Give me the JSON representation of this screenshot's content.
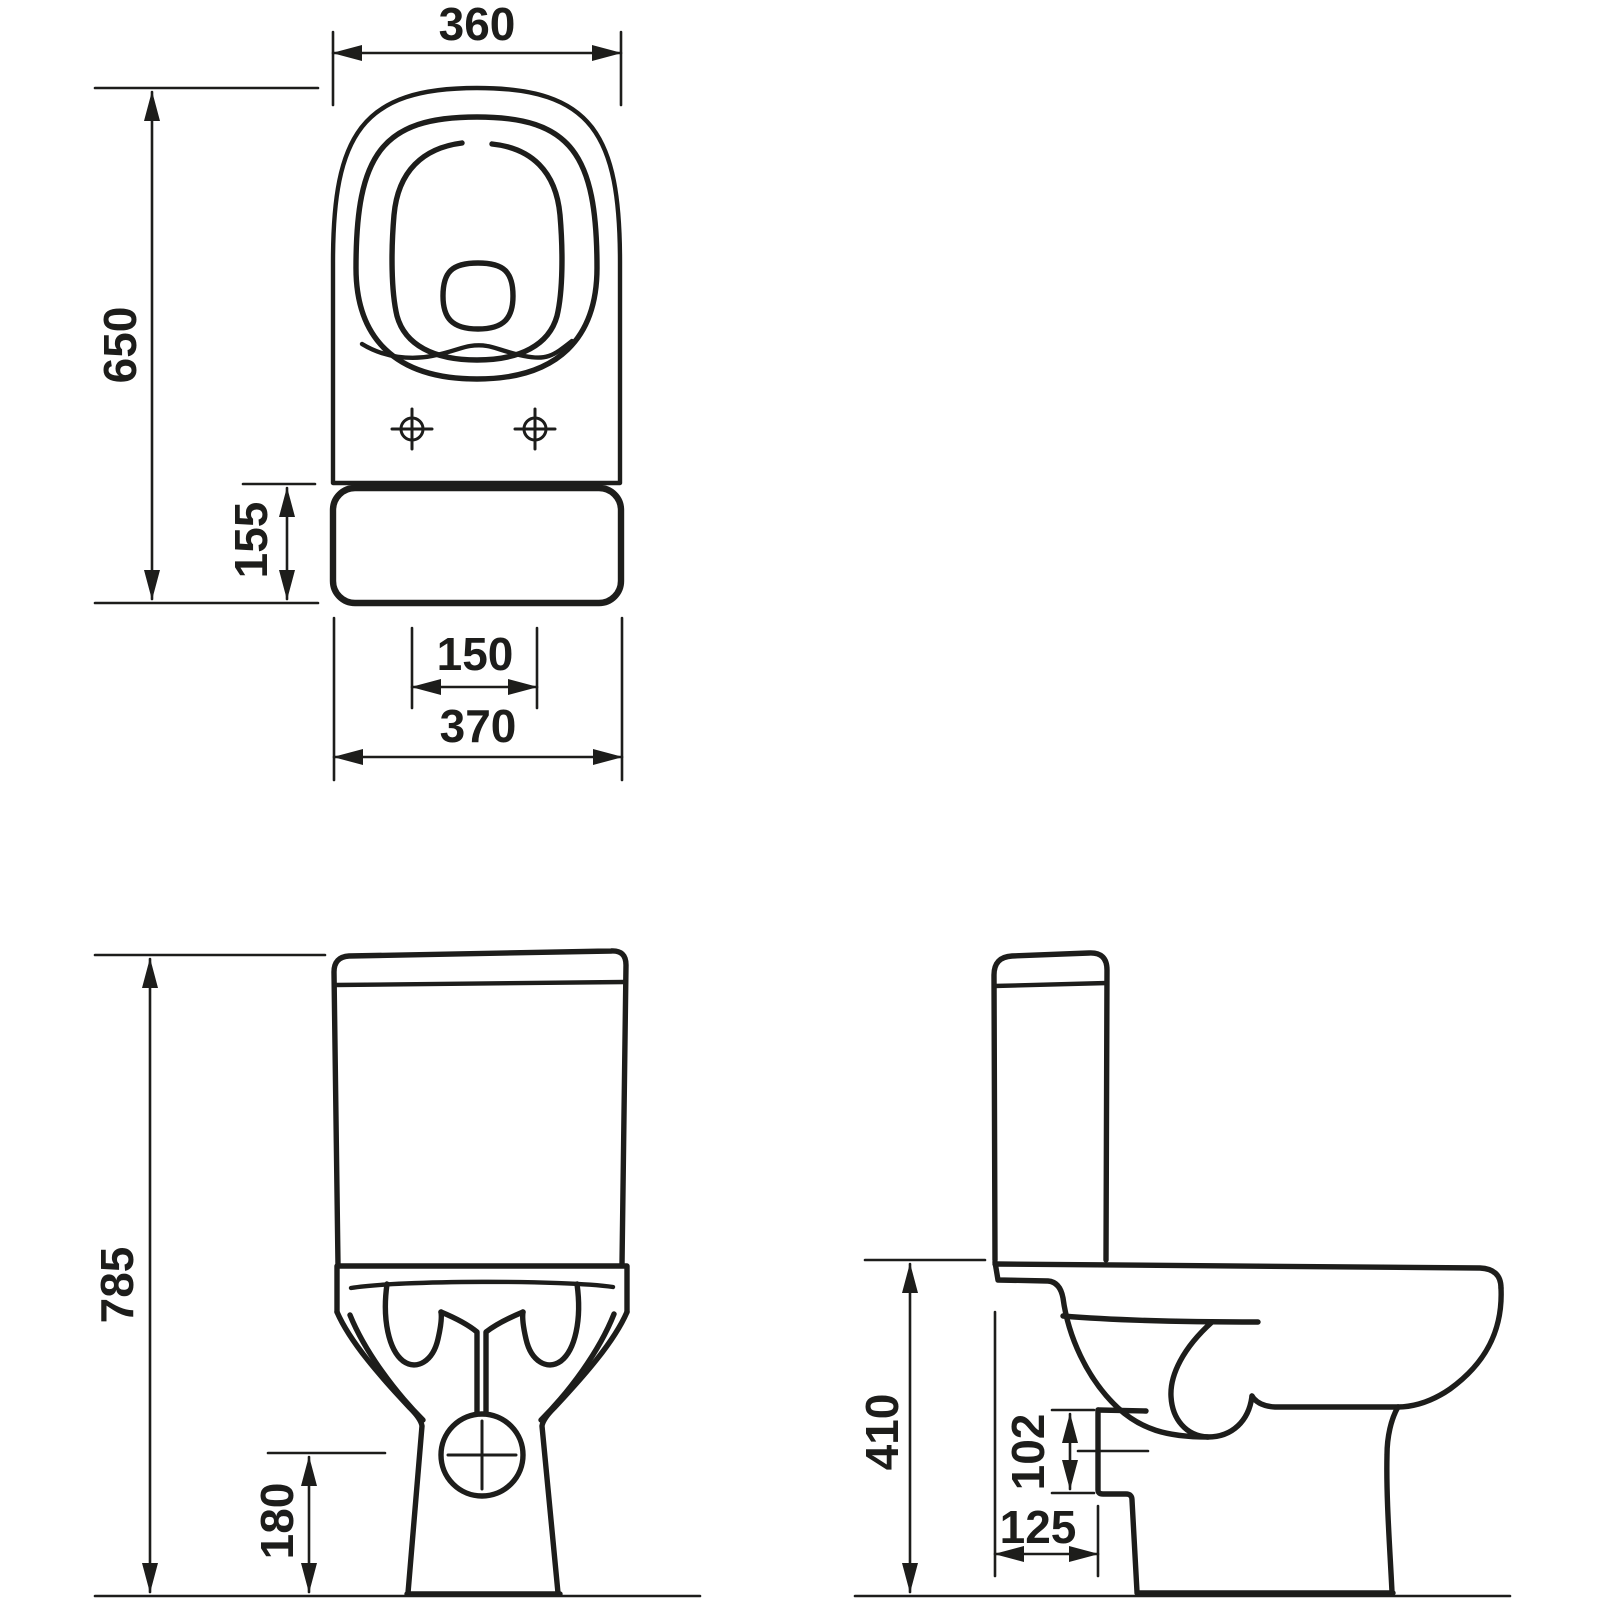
{
  "meta": {
    "doc_type": "technical dimension drawing",
    "subject": "close-coupled toilet (WC) with cistern",
    "views": [
      "top view",
      "front view",
      "side view"
    ]
  },
  "colors": {
    "line": "#1d1d1b",
    "background": "#ffffff"
  },
  "views": {
    "top": {
      "name": "top view",
      "dims": {
        "seat_width": "360",
        "total_depth": "650",
        "tank_section_depth": "155",
        "fixing_hole_spacing": "150",
        "base_width": "370"
      }
    },
    "front": {
      "name": "front view",
      "dims": {
        "total_height": "785",
        "outlet_center_height": "180"
      }
    },
    "side": {
      "name": "side view",
      "dims": {
        "bowl_height": "410",
        "outlet_center_height": "102",
        "outlet_setout": "125"
      }
    }
  }
}
